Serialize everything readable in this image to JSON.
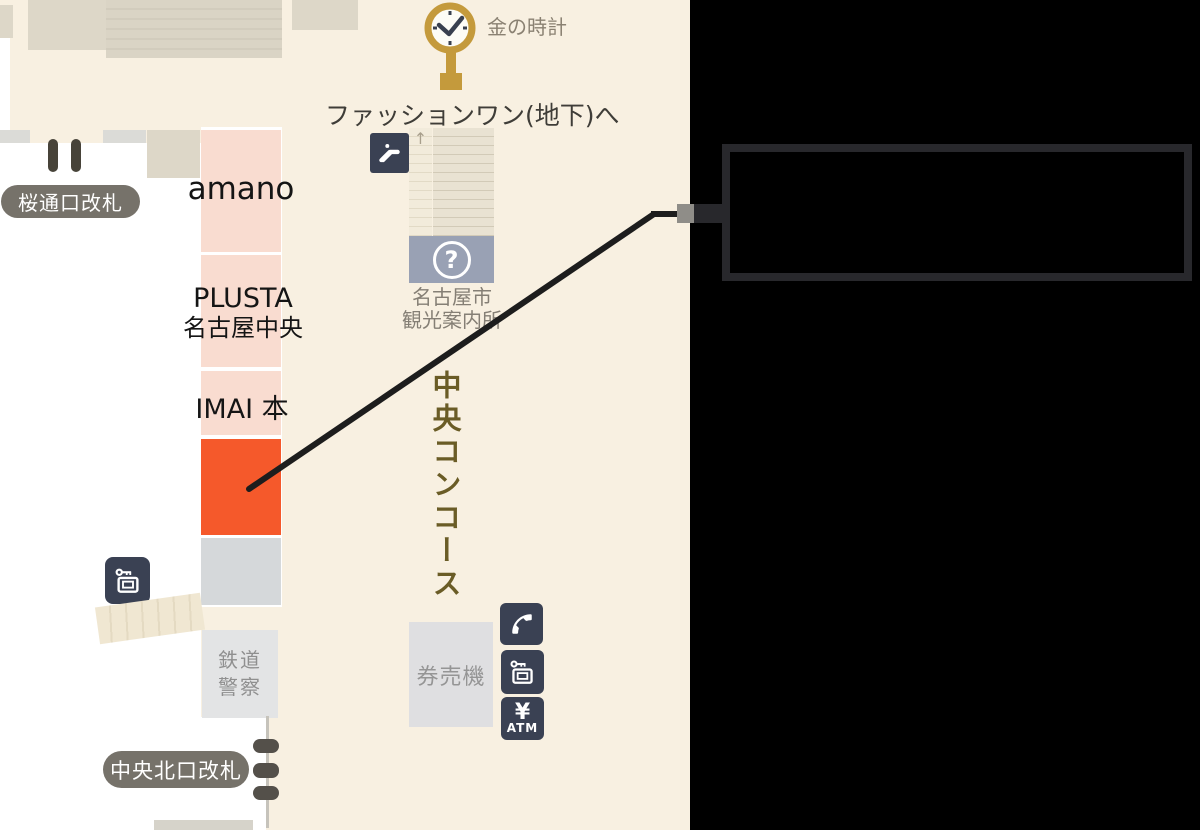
{
  "map": {
    "gold_clock_label": "金の時計",
    "fashion_one_label": "ファッションワン(地下)へ",
    "sakura_gate_label": "桜通口改札",
    "central_north_gate_label": "中央北口改札",
    "concourse_label": "中央コンコース",
    "stairs_arrow": "↑",
    "shops": {
      "amano": "amano",
      "plusta_line1": "PLUSTA",
      "plusta_line2": "名古屋中央",
      "imai": "IMAI 本"
    },
    "tourist_info": {
      "question_mark": "?",
      "line1": "名古屋市",
      "line2": "観光案内所"
    },
    "railway_police": {
      "line1": "鉄道",
      "line2": "警察"
    },
    "ticket_machine_label": "券売機",
    "atm": {
      "yen": "¥",
      "label": "ATM"
    }
  },
  "callout": {
    "text": ""
  },
  "colors": {
    "map_background": "#f8f0e1",
    "highlight_orange": "#f5592b",
    "shop_pink": "#f9dcd0",
    "icon_navy": "#3a4153",
    "badge_gray": "#76726a",
    "gold": "#c49a3c",
    "concourse_text": "#6a5c26",
    "info_blue_gray": "#99a1b4",
    "callout_border": "#28282c",
    "connector_black": "#1d1d1d"
  }
}
